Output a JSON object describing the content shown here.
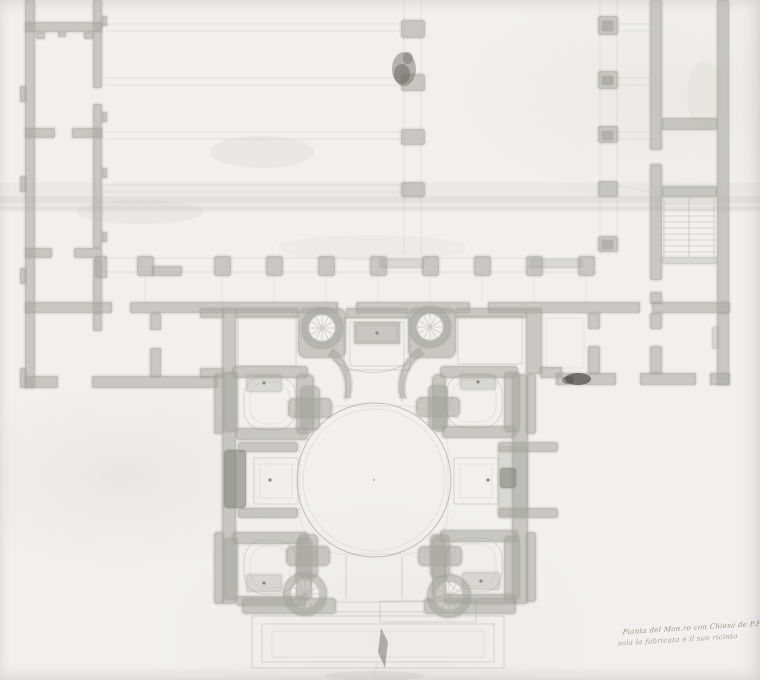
{
  "document": {
    "kind": "hand-drawn architectural floor plan, ink and gray wash on aged paper",
    "subject": "monastery with domed church, cloister wings and cloister arcades",
    "inscription": {
      "line1": "Pianta del Mon.ro con Chiesa de P.P. dell.a",
      "line2": "sola la fabricata e il suo ricinto"
    }
  },
  "colors": {
    "paper": "#f1f0ee",
    "wall": "#a6a5a0",
    "wall-dark": "#8b8a85",
    "line": "#97968f",
    "smudge": "#4e4d49",
    "blot": "#68675f",
    "crease": "#b3b1ac",
    "inscription-ink": "#8d7962"
  },
  "plan": {
    "regions": [
      "left-wing-cells",
      "main-range",
      "right-wing-with-staircase",
      "cloister-south-arcade",
      "cloister-west-pier-column",
      "cloister-east-pier-column",
      "church-block",
      "central-rotunda",
      "corner-chapels",
      "side-altars",
      "high-altar-recess",
      "spiral-staircases",
      "entrance-steps"
    ]
  }
}
